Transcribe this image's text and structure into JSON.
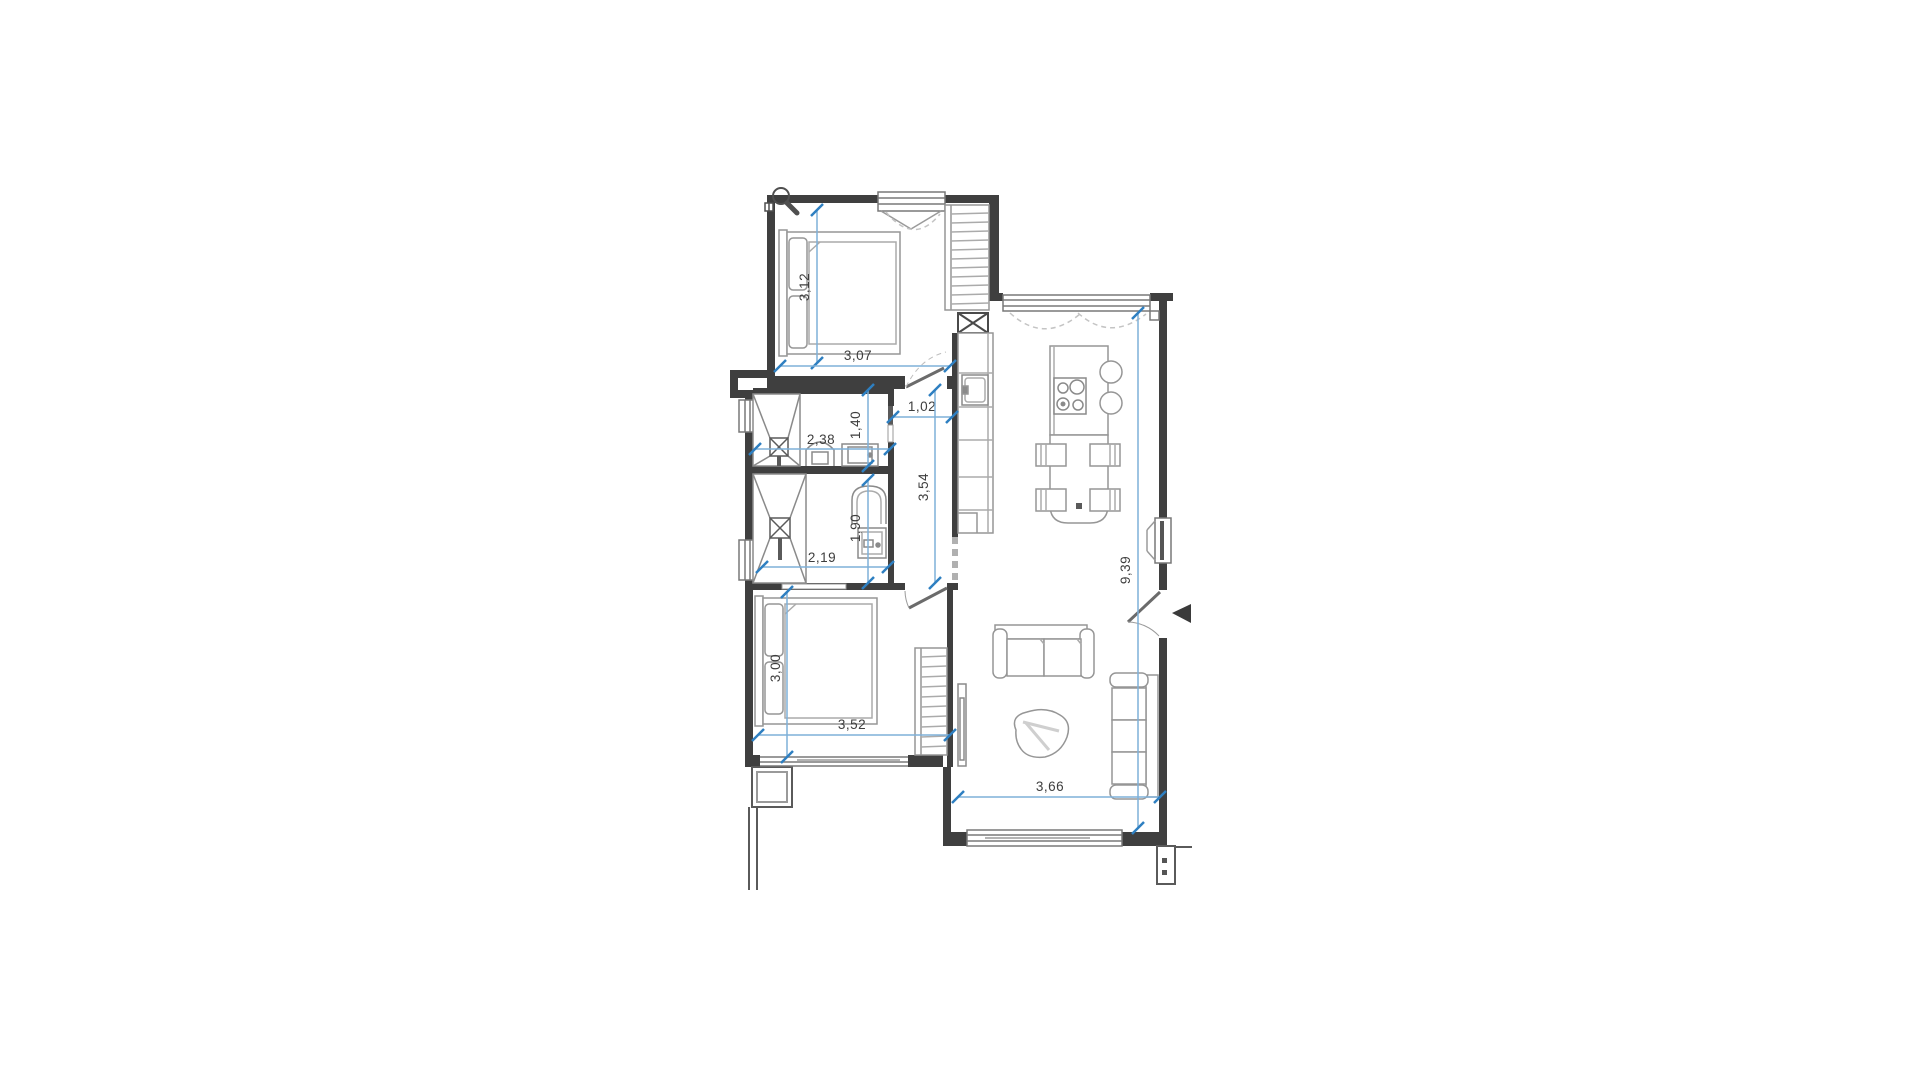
{
  "page": {
    "background": "#ffffff",
    "kind": "architectural floor plan"
  },
  "colors": {
    "wall": "#3f3f3f",
    "furniture": "#969696",
    "fixture": "#8a8a8a",
    "window": "#787878",
    "dimension_line": "#7fb0d8",
    "dimension_tick": "#2e7fc1",
    "dimension_text": "#3d3d3d",
    "entry_marker": "#3a3a3a"
  },
  "icons": [
    {
      "name": "magnifier-icon"
    },
    {
      "name": "entry-arrow-icon"
    }
  ],
  "floorplan": {
    "type": "apartment-floor-plan",
    "rooms": [
      "bedroom-1",
      "bathroom-1",
      "bathroom-2",
      "corridor",
      "bedroom-2",
      "living-kitchen"
    ],
    "dimensions": [
      {
        "id": "bedroom1-depth",
        "value": "3,12",
        "orientation": "vertical"
      },
      {
        "id": "bedroom1-width",
        "value": "3,07",
        "orientation": "horizontal"
      },
      {
        "id": "bathroom1-width",
        "value": "2,38",
        "orientation": "horizontal"
      },
      {
        "id": "bathroom1-depth",
        "value": "1,40",
        "orientation": "vertical"
      },
      {
        "id": "corridor-width",
        "value": "1,02",
        "orientation": "horizontal"
      },
      {
        "id": "corridor-length",
        "value": "3,54",
        "orientation": "vertical"
      },
      {
        "id": "bathroom2-depth",
        "value": "1,90",
        "orientation": "vertical"
      },
      {
        "id": "bathroom2-width",
        "value": "2,19",
        "orientation": "horizontal"
      },
      {
        "id": "bedroom2-depth",
        "value": "3,00",
        "orientation": "vertical"
      },
      {
        "id": "bedroom2-width",
        "value": "3,52",
        "orientation": "horizontal"
      },
      {
        "id": "living-width",
        "value": "3,66",
        "orientation": "horizontal"
      },
      {
        "id": "living-length",
        "value": "9,39",
        "orientation": "vertical"
      }
    ]
  }
}
